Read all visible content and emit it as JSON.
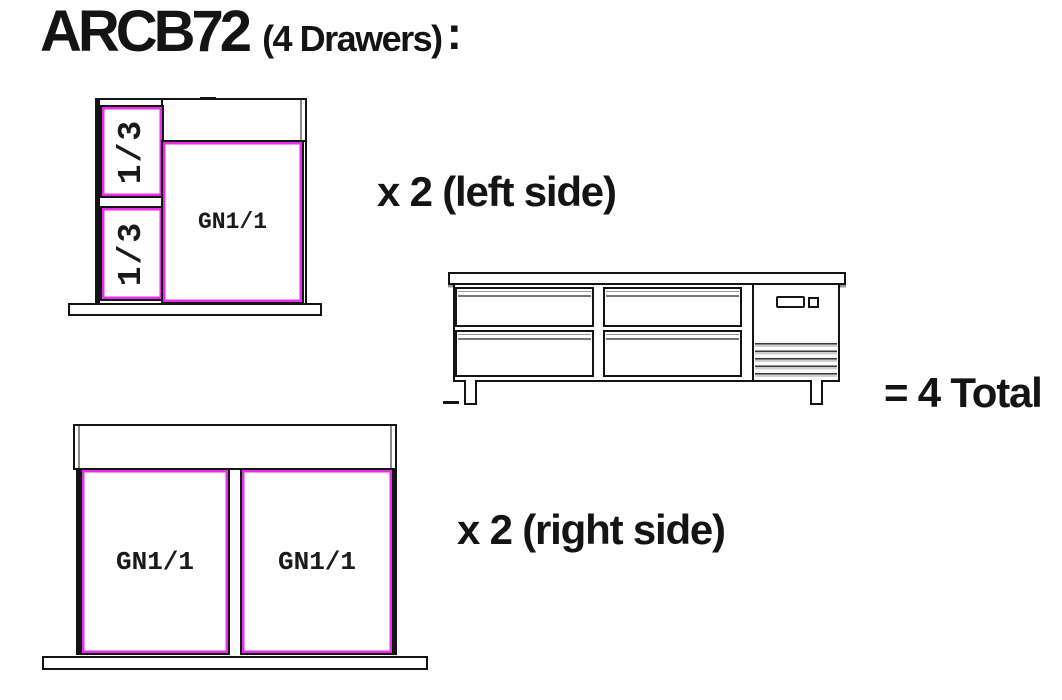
{
  "title": {
    "model": "ARCB72",
    "qualifier": "(4 Drawers)",
    "colon": ":"
  },
  "left_section": {
    "small_pan_top": "1/3",
    "small_pan_bottom": "1/3",
    "large_pan": "GN1/1",
    "note": "x 2 (left side)"
  },
  "right_section": {
    "pan_left": "GN1/1",
    "pan_right": "GN1/1",
    "note": "x 2 (right side)"
  },
  "summary": {
    "total": "= 4 Total"
  },
  "colors": {
    "line": "#141414",
    "pan_accent": "#ea2dea"
  }
}
